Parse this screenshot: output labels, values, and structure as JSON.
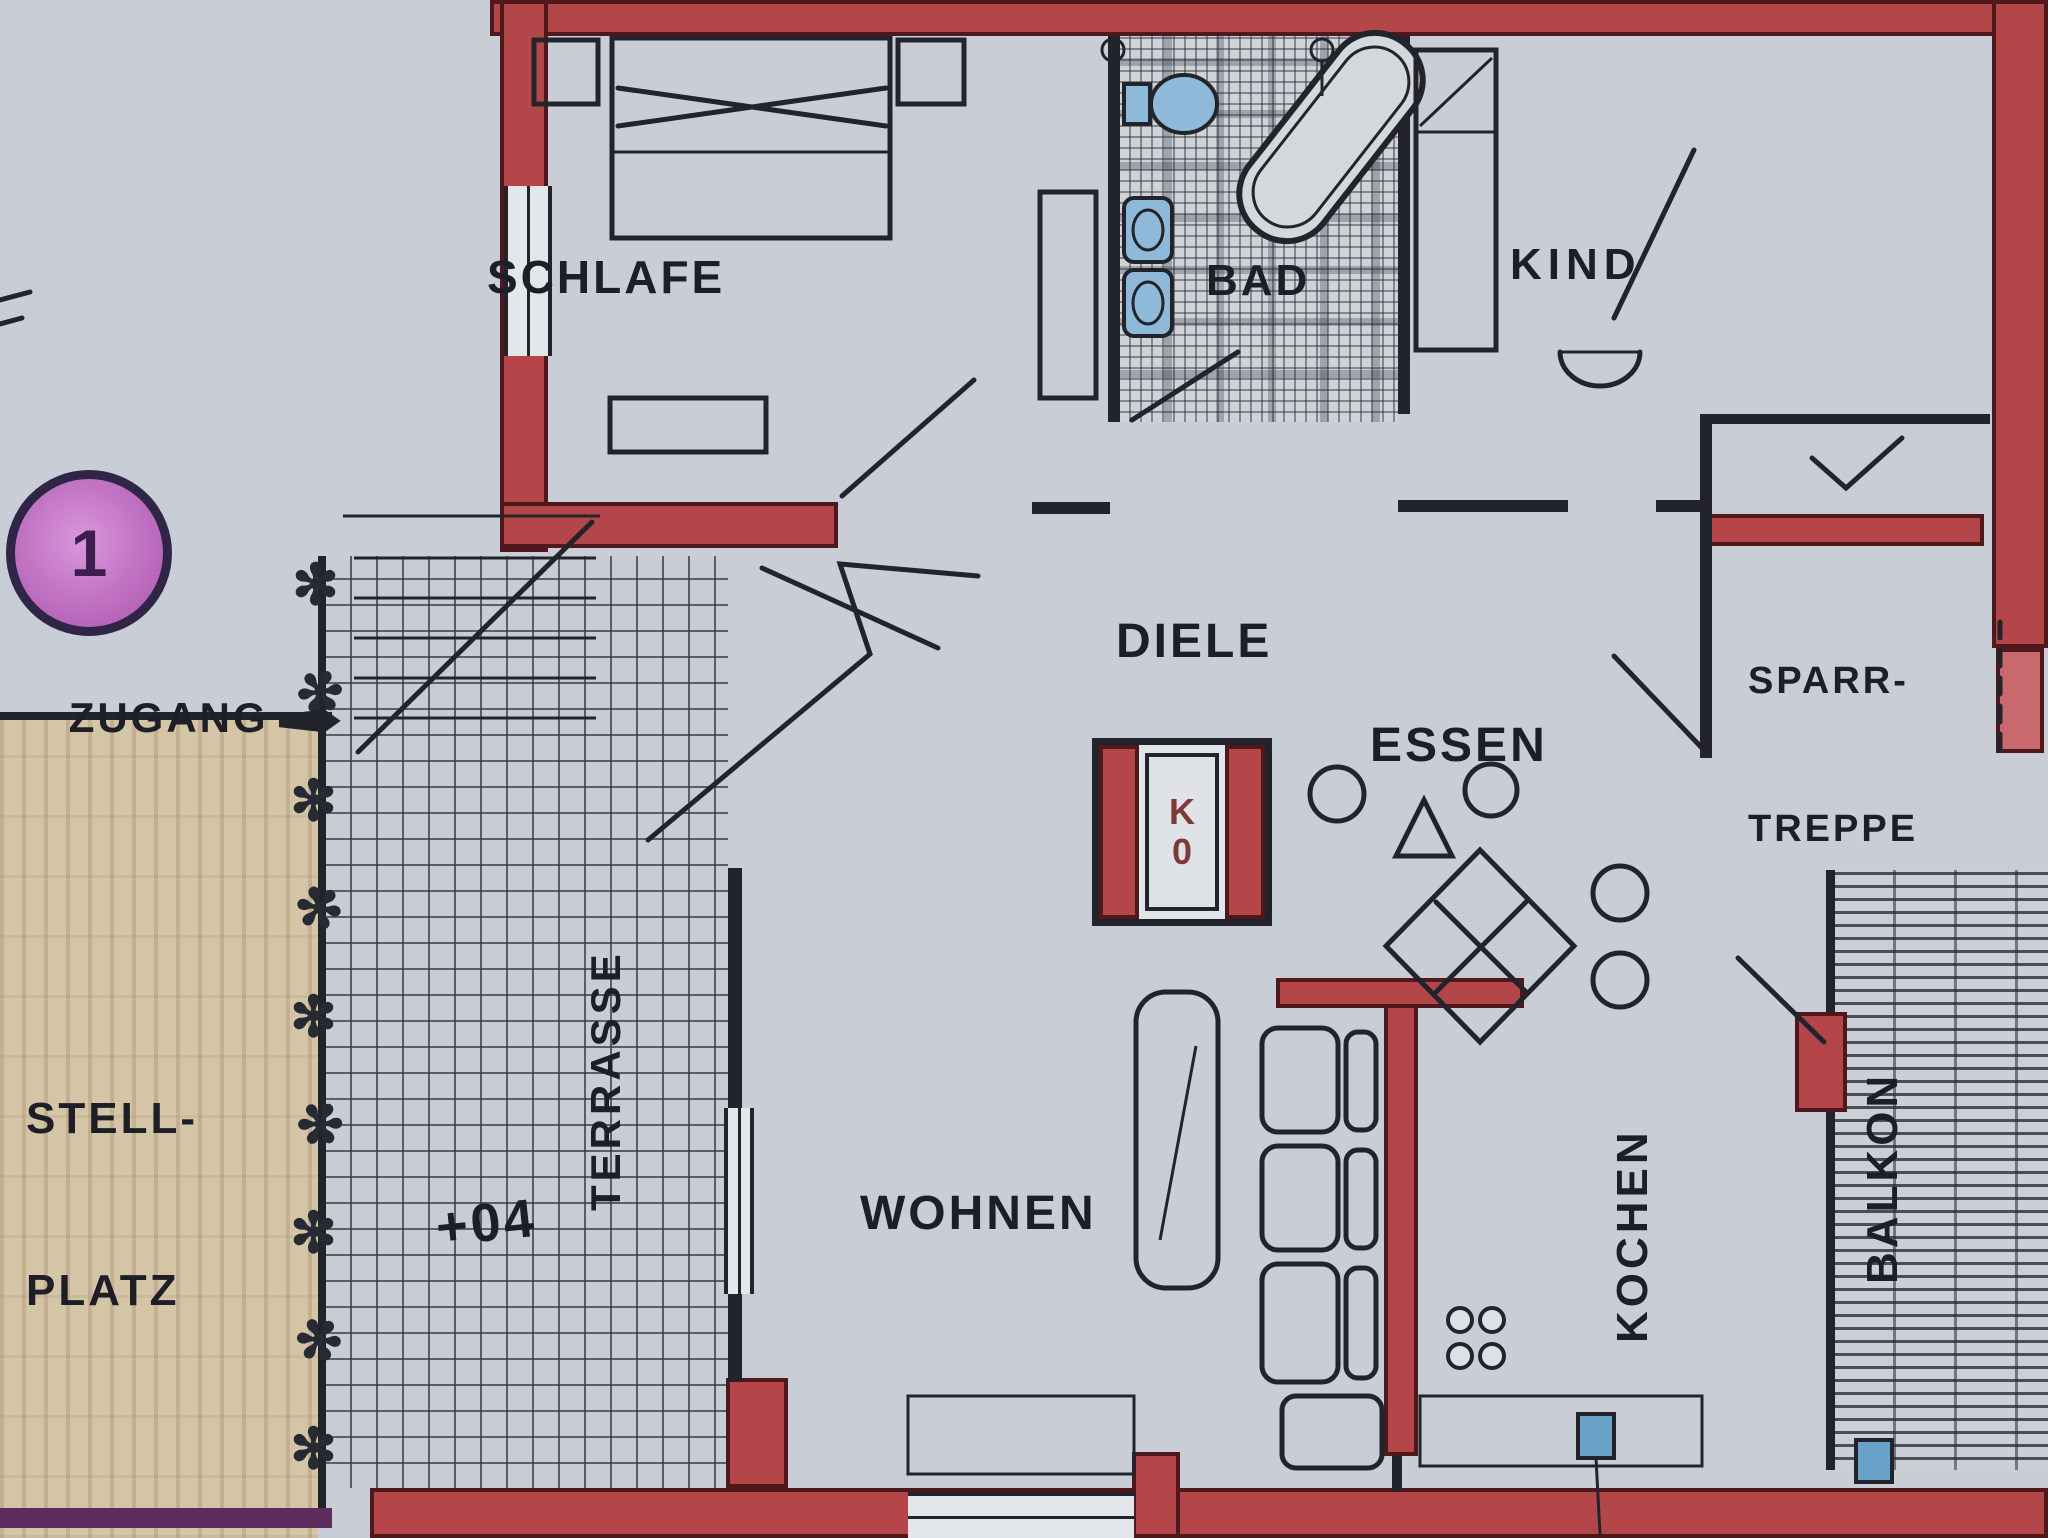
{
  "plan": {
    "rooms": {
      "schlafe": {
        "label": "SCHLAFE"
      },
      "bad": {
        "label": "BAD"
      },
      "kind": {
        "label": "KIND"
      },
      "diele": {
        "label": "DIELE"
      },
      "essen": {
        "label": "ESSEN"
      },
      "sparrtreppe": {
        "label_line1": "SPARR-",
        "label_line2": "TREPPE"
      },
      "wohnen": {
        "label": "WOHNEN"
      },
      "kochen": {
        "label": "KOCHEN"
      },
      "balkon": {
        "label": "BALKON"
      },
      "terrasse": {
        "label": "TERRASSE"
      },
      "stellplatz": {
        "label_line1": "STELL-",
        "label_line2": "PLATZ"
      }
    },
    "annotations": {
      "zugang_label": "ZUGANG",
      "level_marker": "+04",
      "unit_number": "1",
      "shaft_letter_top": "K",
      "shaft_letter_bottom": "0"
    },
    "decor": {
      "plant_glyph": "✻"
    },
    "colors": {
      "wall_red": "#b4464a",
      "wall_dark": "#23242b",
      "fixture_blue": "#8fb9d8",
      "stellplatz_tan": "#d5c5a7",
      "marker_magenta": "#bb66bd",
      "boundary_purple": "#5e2d60"
    }
  }
}
